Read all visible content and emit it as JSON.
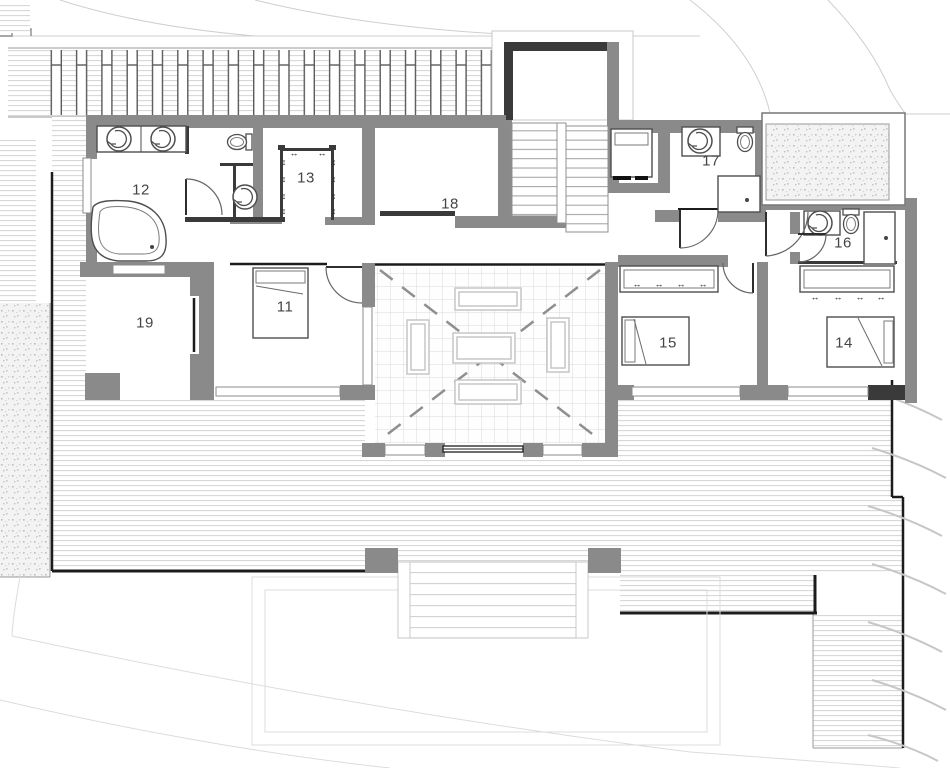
{
  "plan_title": "",
  "rooms": [
    {
      "id": "11",
      "label": "11",
      "x": 285,
      "y": 307
    },
    {
      "id": "12",
      "label": "12",
      "x": 141,
      "y": 190
    },
    {
      "id": "13",
      "label": "13",
      "x": 306,
      "y": 178
    },
    {
      "id": "14",
      "label": "14",
      "x": 844,
      "y": 343
    },
    {
      "id": "15",
      "label": "15",
      "x": 668,
      "y": 343
    },
    {
      "id": "16",
      "label": "16",
      "x": 843,
      "y": 243
    },
    {
      "id": "17",
      "label": "17",
      "x": 711,
      "y": 161
    },
    {
      "id": "18",
      "label": "18",
      "x": 450,
      "y": 204
    },
    {
      "id": "19",
      "label": "19",
      "x": 145,
      "y": 323
    }
  ],
  "symbols": {
    "hanger_h": "↔",
    "hanger_v": "↕"
  },
  "colors": {
    "wall": "#8a8a8a",
    "partition": "#3a3a3a",
    "black": "#1c1c1c",
    "deck_line": "#d4d4d4",
    "tile_line": "#dadada",
    "gravel_dot": "#bdbdbd",
    "outline": "#9a9a9a",
    "label": "#454545",
    "paper": "#ffffff"
  }
}
